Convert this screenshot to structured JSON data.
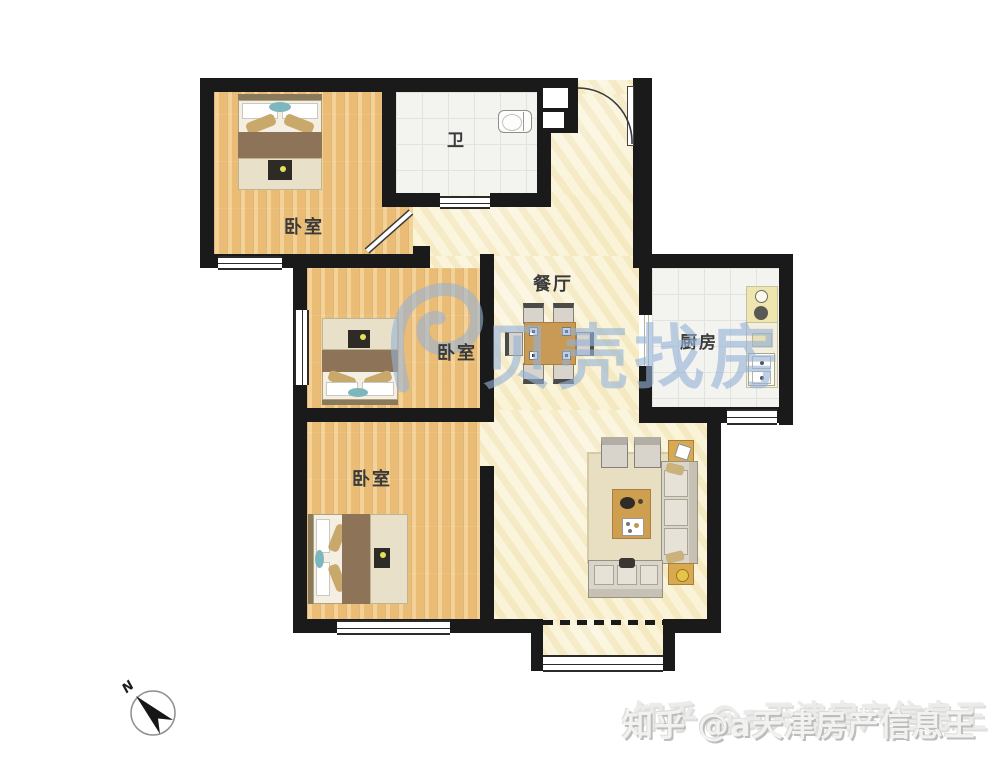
{
  "palette": {
    "wall": "#1a1a1a",
    "wood_floor": "#edc27c",
    "cream_floor": "#f8f0cd",
    "tile_floor": "#f3f3f0",
    "watermark_blue": "#96b1d7",
    "furniture_wood": "#cd9f4e",
    "accent_teal": "#7db6bd"
  },
  "rooms": {
    "bedroom1": {
      "label": "卧室"
    },
    "bedroom2": {
      "label": "卧室"
    },
    "bedroom3": {
      "label": "卧室"
    },
    "bathroom": {
      "label": "卫"
    },
    "dining": {
      "label": "餐厅"
    },
    "kitchen": {
      "label": "厨房"
    }
  },
  "compass": {
    "label": "N"
  },
  "watermarks": {
    "brand": "贝壳找房",
    "credit": "知乎 @a天津房产信息王"
  }
}
